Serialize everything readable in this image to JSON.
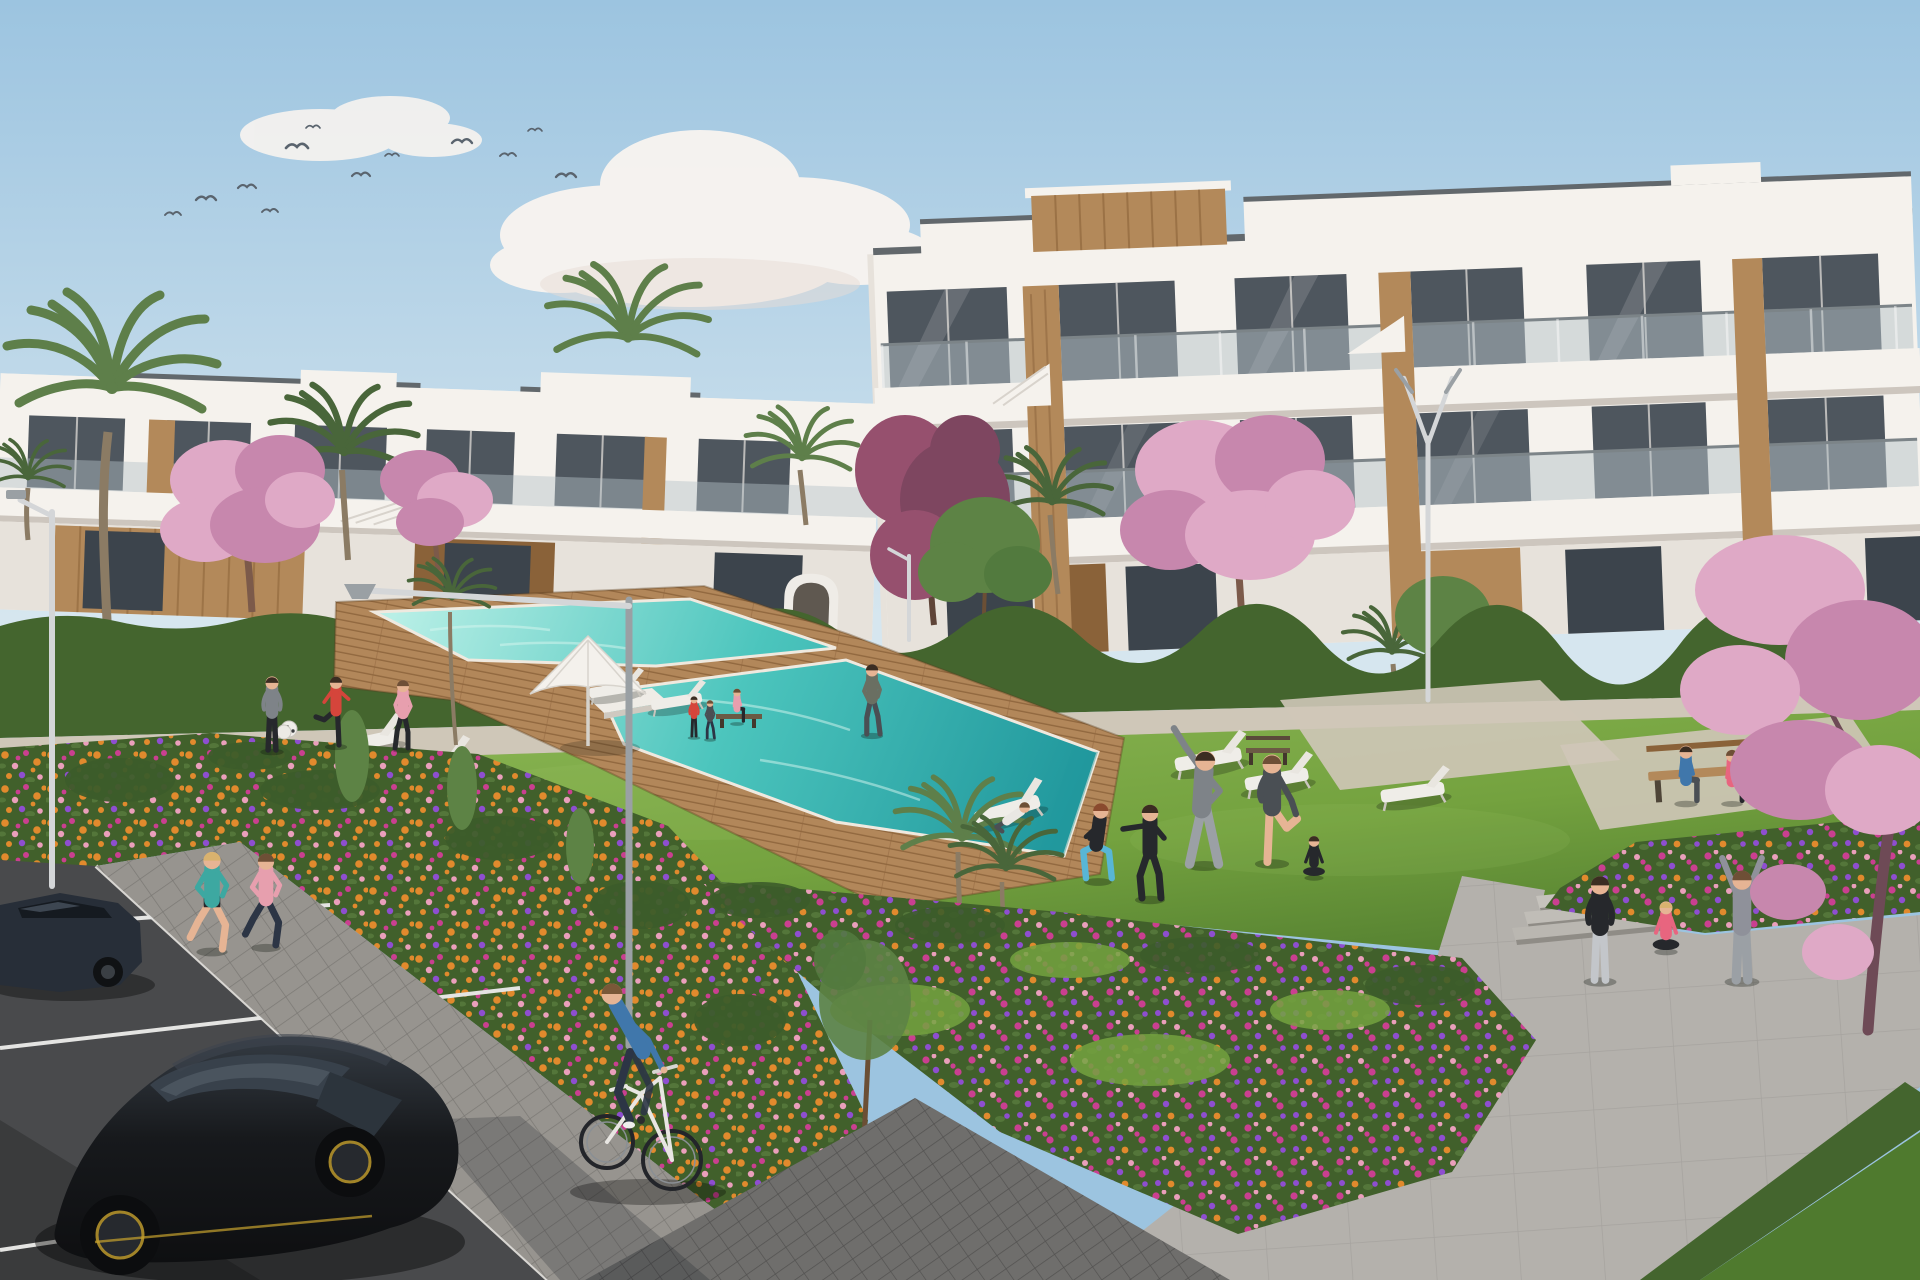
{
  "meta": {
    "title": "Architectural rendering of a residential apartment complex with communal pool, gardens and parking"
  },
  "palette": {
    "sky_top": "#9cc4e0",
    "sky_low": "#d6e6ef",
    "cloud": "#f8f4f0",
    "cloud_shade": "#e8dcd6",
    "bird": "#5a646e",
    "white": "#f5f2ed",
    "white_shade": "#e7e2db",
    "slab_shadow": "#cdc6be",
    "roof_line": "#62686c",
    "glass": "#4e565e",
    "glass_hi": "#87949c",
    "railing": "#b6c1c7",
    "wood": "#b3895a",
    "wood_dark": "#8a6239",
    "wood_hi": "#caa36c",
    "lawn": "#74a23f",
    "lawn_hi": "#8cb755",
    "lawn_sh": "#4f7a2e",
    "hedge": "#44652e",
    "bush": "#3c5c2a",
    "tree": "#5d8345",
    "palm": "#5e7f4a",
    "palm_dark": "#49663a",
    "trunk": "#8b7b64",
    "blossom": "#dfa9c6",
    "blossom_dp": "#c787ad",
    "maroon": "#96506e",
    "fl_base": "#41602b",
    "fl_orange": "#e18a2d",
    "fl_magenta": "#ca3f90",
    "fl_purple": "#8e4ed0",
    "fl_pink": "#ea9fbb",
    "path": "#cfc7b8",
    "plaza": "#b4b1ac",
    "paver": "#97948f",
    "paver_dk": "#6f6e6c",
    "road": "#494a4c",
    "curb": "#e8e8e6",
    "pool_hi": "#b8efe6",
    "pool": "#4cc5bd",
    "pool_dp": "#21989d",
    "deck": "#b2875a",
    "deck_dk": "#91683f",
    "car": "#1a1c1f",
    "car_hi": "#3d454e",
    "car_glass": "#38414b",
    "rim_y": "#c8a32e",
    "car2": "#272e38",
    "lamp": "#d4d6d8",
    "lamp_dk": "#9aa0a4",
    "skin": "#e6b494",
    "hair": "#6e4f36",
    "hair_dark": "#3b2d22",
    "hair_blonde": "#d9b26e",
    "hair_red": "#8a4a2e",
    "teal": "#3da8a1",
    "red": "#d5453b",
    "pink": "#e79fae",
    "pink_dp": "#e8657f",
    "blue": "#4077ab",
    "denim": "#2c3545",
    "gray_tee": "#7e8388",
    "gray_lt": "#9ba0a5",
    "black_cloth": "#26282c",
    "dark_cloth": "#4a4f54",
    "hoodie": "#8f919a",
    "olive": "#6a6f62",
    "white_cloth": "#e9e7e3",
    "legging_blue": "#58b6d6",
    "legging_gray": "#c3c6ca"
  },
  "scene": {
    "sky": {
      "birds": 12,
      "clouds": 5
    },
    "buildings": [
      {
        "id": "right-block",
        "floors": 3,
        "style": "white modern with wood panels, glass balconies"
      },
      {
        "id": "left-block",
        "floors": 2,
        "style": "white modern with wood cladding ground floor"
      }
    ],
    "vegetation": {
      "palms": 9,
      "blossom_trees": 5,
      "green_trees": 3,
      "flower_beds": 3,
      "hedges": 2
    },
    "pool": {
      "water": "turquoise",
      "deck": "wood",
      "loungers": 8,
      "parasols": 1,
      "island_platform": 1
    },
    "street": {
      "lamps": 4,
      "benches": 3,
      "parking_lines": 3,
      "cars": 2,
      "bicycles": 1
    },
    "people": [
      {
        "id": "jogger-teal",
        "x": 212,
        "y": 950,
        "h": 104,
        "pose": "run",
        "shirt": "teal",
        "pants": "black_cloth",
        "legs": "skin",
        "hair": "hair_blonde"
      },
      {
        "id": "jogger-pink",
        "x": 266,
        "y": 946,
        "h": 98,
        "pose": "run",
        "shirt": "pink",
        "pants": "denim",
        "hair": "hair"
      },
      {
        "id": "kicker-red",
        "x": 336,
        "y": 745,
        "h": 74,
        "pose": "kick",
        "shirt": "red",
        "pants": "black_cloth",
        "hair": "hair_dark",
        "flip": true
      },
      {
        "id": "man-gray-ball",
        "x": 272,
        "y": 750,
        "h": 78,
        "pose": "stand",
        "shirt": "gray_tee",
        "pants": "black_cloth",
        "hair": "hair_dark"
      },
      {
        "id": "woman-pink",
        "x": 403,
        "y": 748,
        "h": 72,
        "pose": "walk",
        "shirt": "pink",
        "pants": "black_cloth",
        "hair": "hair",
        "flip": true
      },
      {
        "id": "walker-towel",
        "x": 872,
        "y": 734,
        "h": 74,
        "pose": "walk",
        "shirt": "olive",
        "pants": "dark_cloth",
        "hair": "hair_dark"
      },
      {
        "id": "tiny-red",
        "x": 694,
        "y": 736,
        "h": 42,
        "pose": "stand",
        "shirt": "red",
        "pants": "black_cloth",
        "hair": "hair_dark"
      },
      {
        "id": "tiny-dark",
        "x": 710,
        "y": 738,
        "h": 40,
        "pose": "walk",
        "shirt": "dark_cloth",
        "pants": "denim",
        "hair": "hair"
      },
      {
        "id": "recliner",
        "x": 1008,
        "y": 830,
        "h": 64,
        "pose": "recline",
        "shirt": "white_cloth",
        "pants": "dark_cloth",
        "hair": "hair"
      },
      {
        "id": "squat-woman",
        "x": 1098,
        "y": 880,
        "h": 92,
        "pose": "squat",
        "shirt": "black_cloth",
        "pants": "legging_blue",
        "hair": "hair_red"
      },
      {
        "id": "boxer",
        "x": 1150,
        "y": 898,
        "h": 100,
        "pose": "punch",
        "shirt": "black_cloth",
        "pants": "black_cloth",
        "hair": "hair_dark"
      },
      {
        "id": "stretch-man",
        "x": 1204,
        "y": 864,
        "h": 120,
        "pose": "stretch",
        "shirt": "gray_tee",
        "pants": "gray_lt",
        "hair": "hair_dark"
      },
      {
        "id": "leg-raise-man",
        "x": 1272,
        "y": 862,
        "h": 114,
        "pose": "standleg",
        "shirt": "dark_cloth",
        "pants": "dark_cloth",
        "legs": "skin",
        "hair": "hair"
      },
      {
        "id": "sit-cross-small",
        "x": 1314,
        "y": 876,
        "h": 64,
        "pose": "sitcross",
        "shirt": "black_cloth",
        "pants": "black_cloth",
        "hair": "hair_dark"
      },
      {
        "id": "bench-man",
        "x": 1686,
        "y": 802,
        "h": 78,
        "pose": "sitbench",
        "shirt": "blue",
        "pants": "dark_cloth",
        "hair": "hair_dark"
      },
      {
        "id": "bench-woman",
        "x": 1732,
        "y": 802,
        "h": 72,
        "pose": "sitbench",
        "shirt": "pink_dp",
        "pants": "black_cloth",
        "hair": "hair"
      },
      {
        "id": "bench-sitter-small",
        "x": 737,
        "y": 722,
        "h": 46,
        "pose": "sitbench",
        "shirt": "pink",
        "pants": "black_cloth",
        "hair": "hair"
      },
      {
        "id": "plaza-stand-woman",
        "x": 1600,
        "y": 980,
        "h": 110,
        "pose": "stand",
        "shirt": "black_cloth",
        "pants": "legging_gray",
        "hair": "hair_dark"
      },
      {
        "id": "plaza-sit-woman",
        "x": 1666,
        "y": 950,
        "h": 78,
        "pose": "sitcross",
        "shirt": "pink_dp",
        "pants": "black_cloth",
        "hair": "hair_blonde"
      },
      {
        "id": "plaza-armsup",
        "x": 1742,
        "y": 980,
        "h": 116,
        "pose": "armsup",
        "shirt": "hoodie",
        "pants": "gray_lt",
        "hair": "hair"
      }
    ]
  }
}
